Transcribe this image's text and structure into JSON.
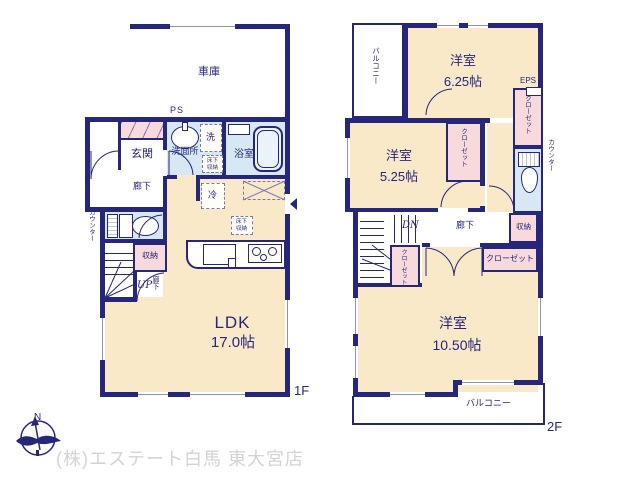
{
  "colors": {
    "wall": "#26267b",
    "ink": "#26267b",
    "room": "#f9e9c8",
    "pink": "#f9dadc",
    "blue": "#d7e7f4",
    "win": "#8d93bd",
    "gray": "#d3d3d3"
  },
  "floor1": {
    "floor_label": "1F",
    "garage_label": "車庫",
    "ps_label": "PS",
    "entrance_label": "玄関",
    "hall_label": "廊下",
    "washroom_label": "洗面所",
    "washer_label": "洗",
    "underfloor_label_a": "床下収納",
    "underfloor_label_b": "床下収納",
    "bath_label": "浴室",
    "counter_label": "カウンター",
    "storage_label": "収納",
    "stairs_up_label": "UP",
    "hall2_label": "廊下",
    "fridge_label": "冷",
    "ldk_label": "LDK",
    "ldk_size": "17.0帖"
  },
  "floor2": {
    "floor_label": "2F",
    "balcony_top_label": "バルコニー",
    "balcony_bottom_label": "バルコニー",
    "room_a_label": "洋室",
    "room_a_size": "6.25帖",
    "room_b_label": "洋室",
    "room_b_size": "5.25帖",
    "room_c_label": "洋室",
    "room_c_size": "10.50帖",
    "eps_label": "EPS",
    "closet_a_label": "クローゼット",
    "closet_b_label": "クローゼット",
    "closet_c_label": "クローゼット",
    "closet_d_label": "クローゼット",
    "counter_label": "カウンター",
    "stairs_down_label": "DN",
    "hall_label": "廊下",
    "storage_label": "収納"
  },
  "footer": {
    "compass_label": "N",
    "company": "(株)エステート白馬 東大宮店"
  }
}
